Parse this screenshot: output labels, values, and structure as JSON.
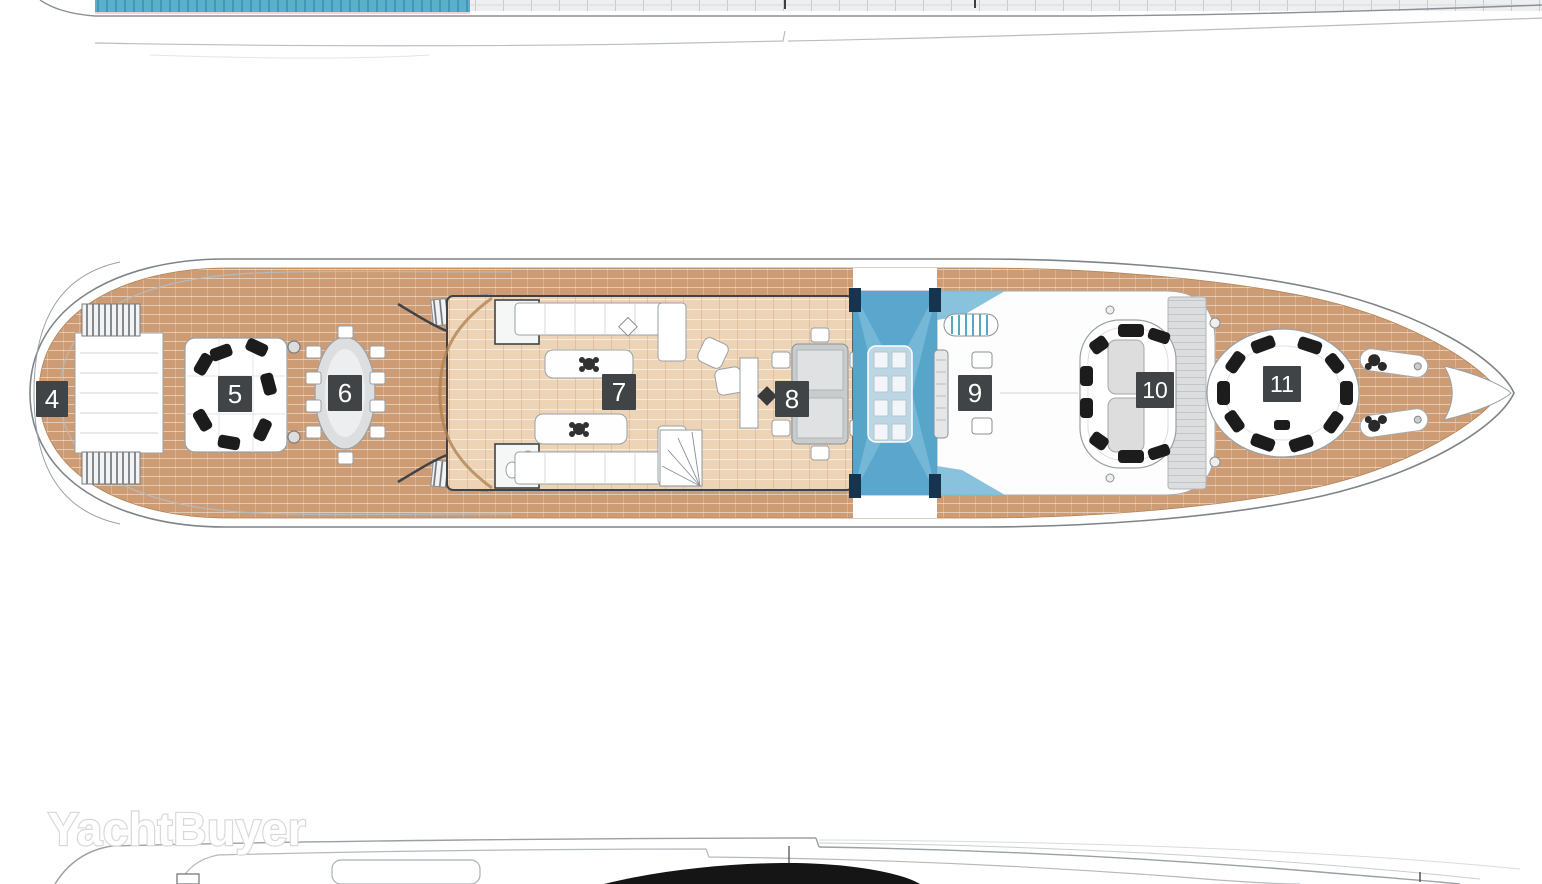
{
  "watermark": {
    "text": "YachtBuyer"
  },
  "deck_labels": [
    {
      "value": "4"
    },
    {
      "value": "5"
    },
    {
      "value": "6"
    },
    {
      "value": "7"
    },
    {
      "value": "8"
    },
    {
      "value": "9"
    },
    {
      "value": "10"
    },
    {
      "value": "11"
    }
  ],
  "colors": {
    "label_bg": "#404447",
    "label_text": "#ffffff",
    "teak_deck": "#cd9c74",
    "interior_wood": "#eed4b6",
    "glass_blue": "#74b7d6",
    "glass_blue_dark": "#4d9cc4",
    "glass_corner_navy": "#16344e",
    "pool_blue": "#58b1c8",
    "hull_outline": "#8a9096",
    "wall_dark": "#3f4347",
    "cushion_black": "#1c1c1c",
    "watermark_outline": "#d9d9d9"
  }
}
